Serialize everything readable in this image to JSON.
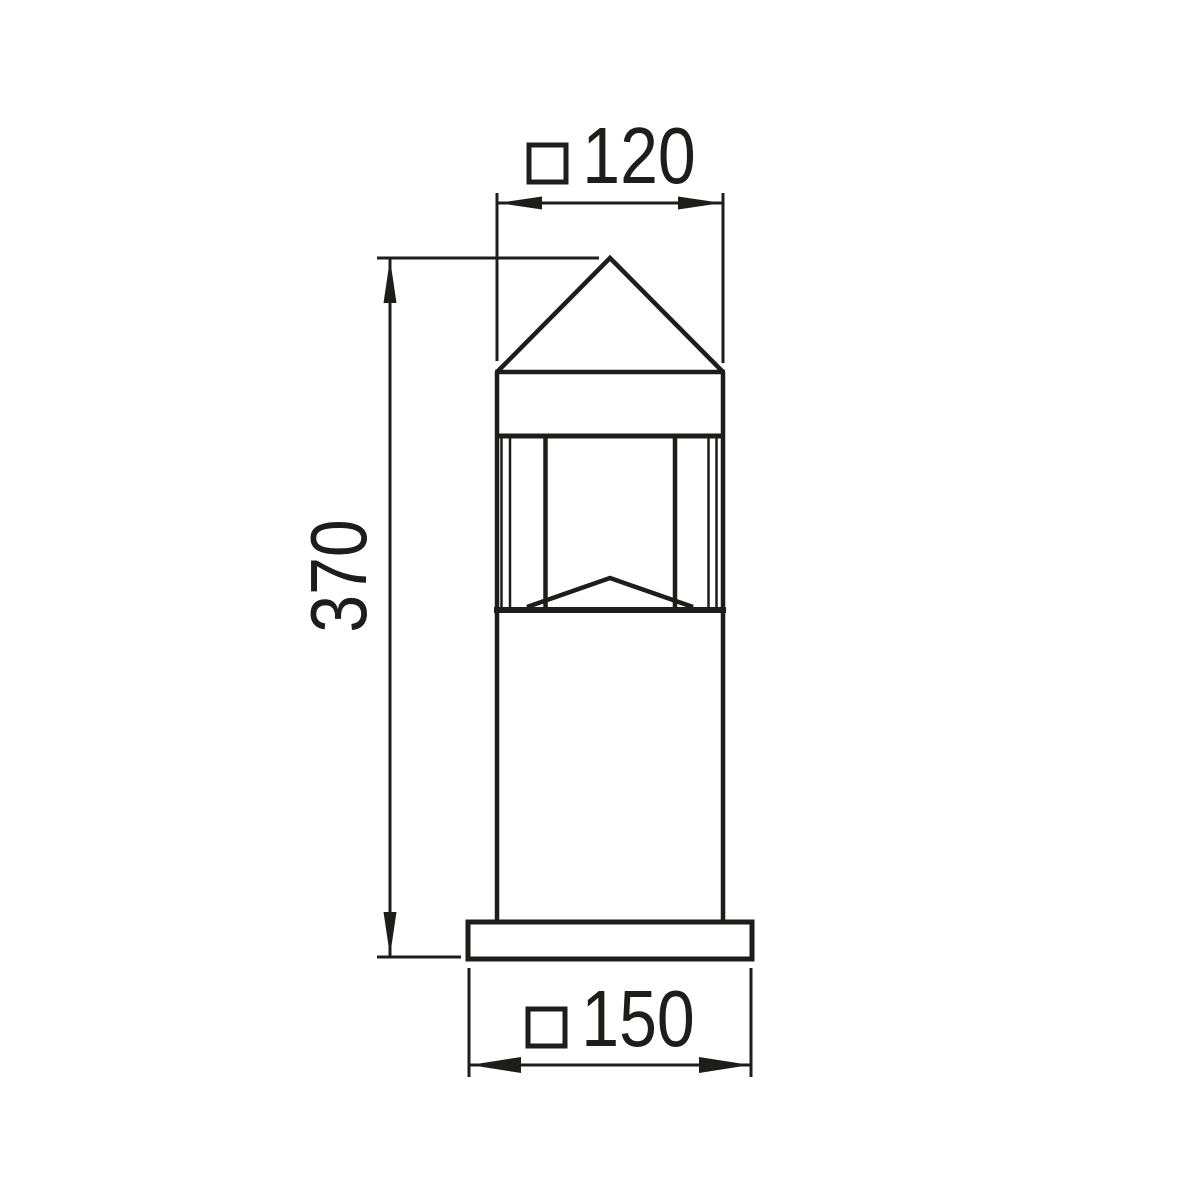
{
  "page": {
    "background_color": "#ffffff"
  },
  "drawing": {
    "type": "technical-dimension-drawing",
    "subject": "square bollard luminaire with pyramid cap, front elevation",
    "line_color": "#1d1d1b",
    "dimensions": {
      "head_width": {
        "symbol": "square-section",
        "symbol_glyph": "□",
        "value": "120"
      },
      "height": {
        "value": "370"
      },
      "base_width": {
        "symbol": "square-section",
        "symbol_glyph": "□",
        "value": "150"
      }
    }
  }
}
